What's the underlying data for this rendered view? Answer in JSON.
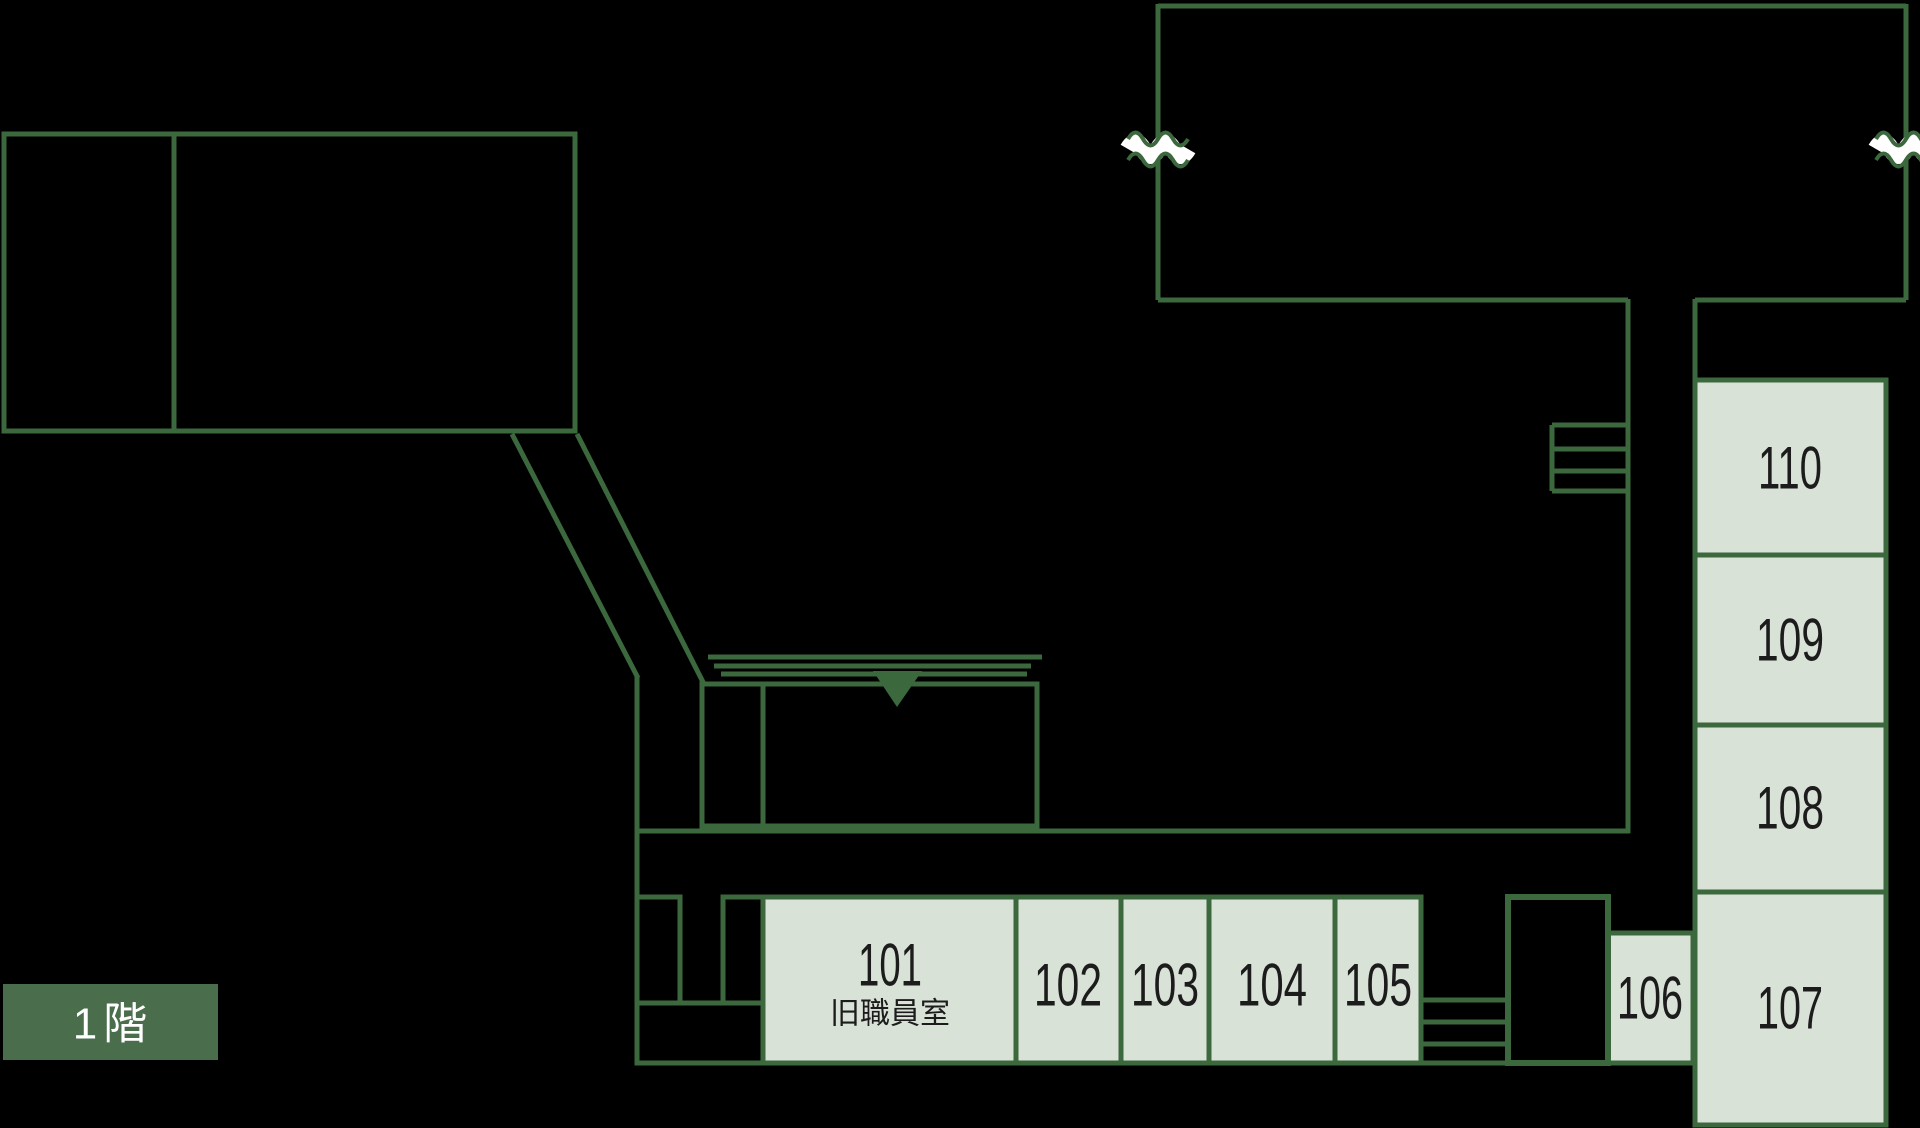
{
  "floor_badge": "1階",
  "rooms": {
    "r101": {
      "number": "101",
      "name": "旧職員室"
    },
    "r102": {
      "number": "102"
    },
    "r103": {
      "number": "103"
    },
    "r104": {
      "number": "104"
    },
    "r105": {
      "number": "105"
    },
    "r106": {
      "number": "106"
    },
    "r107": {
      "number": "107"
    },
    "r108": {
      "number": "108"
    },
    "r109": {
      "number": "109"
    },
    "r110": {
      "number": "110"
    }
  },
  "icons": {
    "entrance_triangle": "▼",
    "wall_break_mark": "〰",
    "stairs_mark": "≡"
  },
  "colors": {
    "outline_green": "#3b683d",
    "room_fill": "#d9e2d7",
    "floor_badge_bg": "#4a6d4b",
    "floor_badge_text": "#ffffff",
    "room_text": "#1c1c1c",
    "background": "#000000"
  }
}
